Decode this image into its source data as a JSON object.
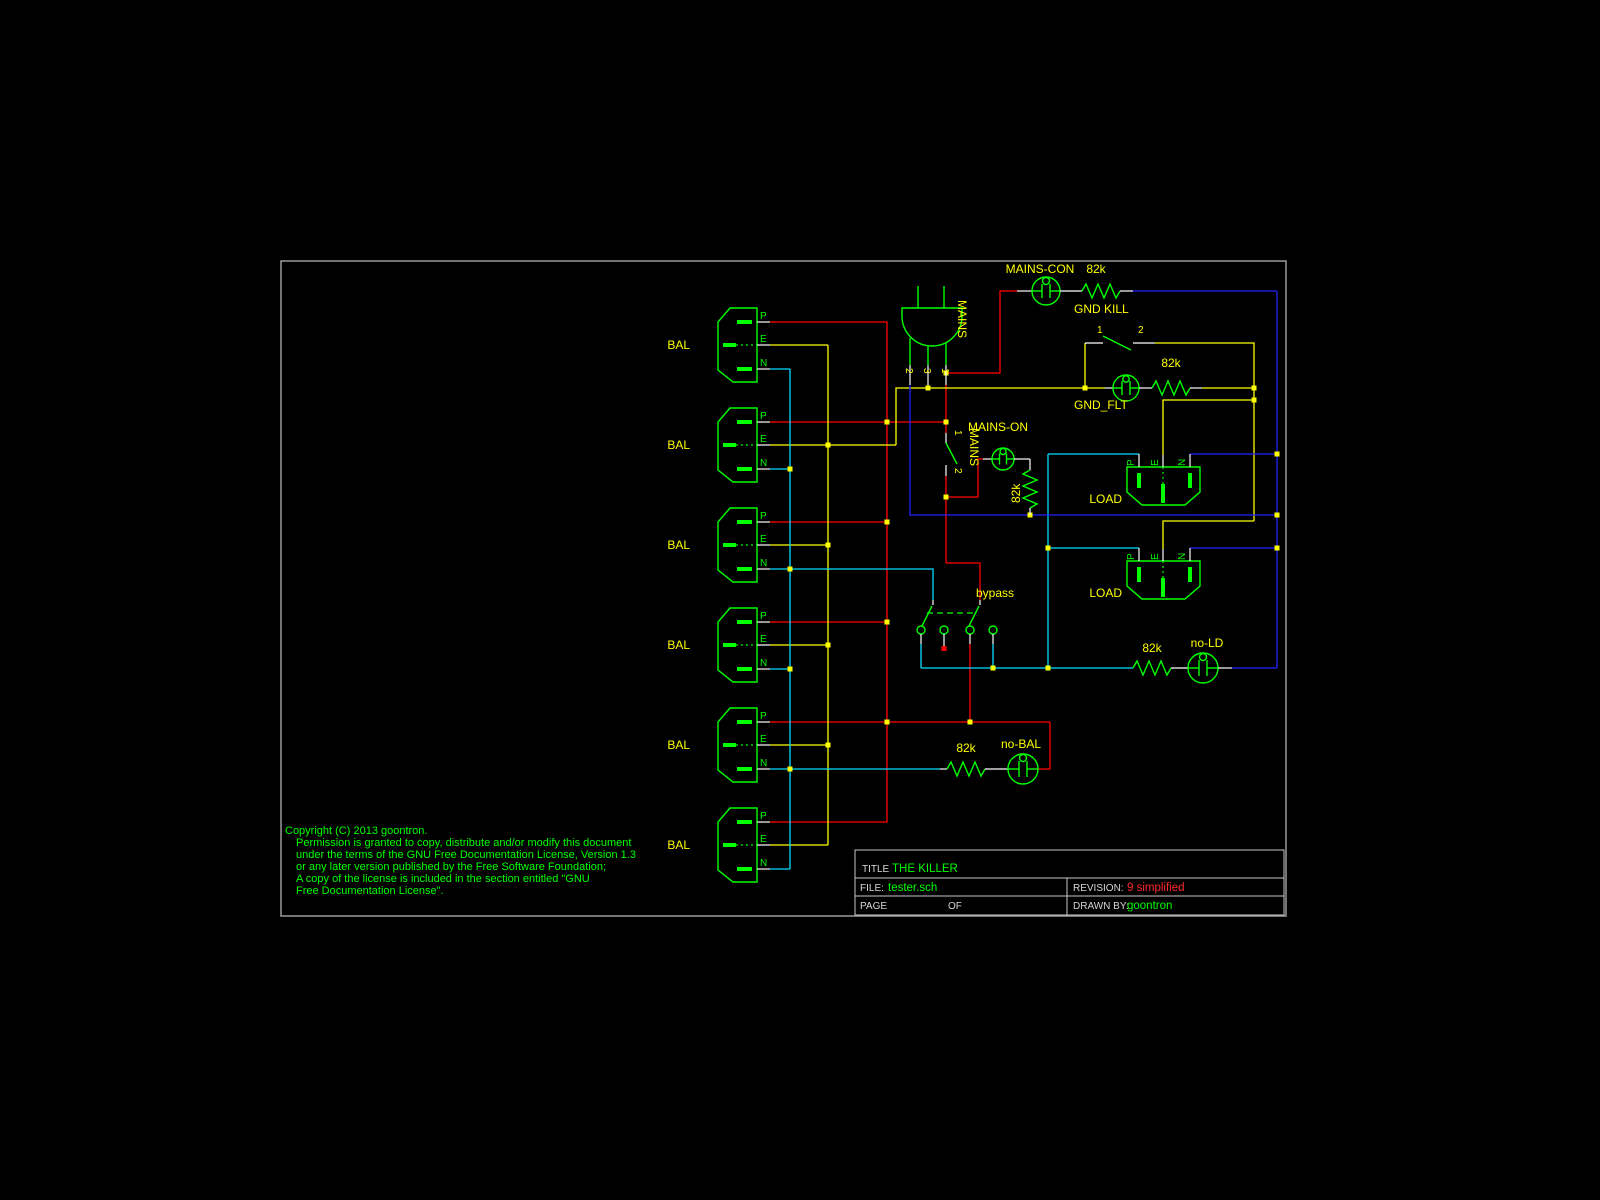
{
  "sheet": {
    "title_label": "TITLE",
    "title": "THE KILLER",
    "file_label": "FILE:",
    "file": "tester.sch",
    "revision_label": "REVISION:",
    "revision": "9 simplified",
    "page_label": "PAGE",
    "of_label": "OF",
    "drawn_label": "DRAWN BY:",
    "drawn_by": "goontron"
  },
  "copyright": {
    "lines": [
      "Copyright (C)  2013 goontron.",
      "Permission is granted to copy, distribute and/or modify this document",
      "under the terms of the GNU Free Documentation License, Version 1.3",
      "or any later version published by the Free Software Foundation;",
      "A copy of the license is included in the section entitled \"GNU",
      "Free Documentation License\"."
    ]
  },
  "labels": {
    "bal": "BAL",
    "load": "LOAD",
    "mains": "MAINS",
    "mains_con": "MAINS-CON",
    "mains_on": "MAINS-ON",
    "gnd_kill": "GND KILL",
    "gnd_flt": "GND_FLT",
    "bypass": "bypass",
    "no_ld": "no-LD",
    "no_bal": "no-BAL",
    "r82k": "82k"
  },
  "pins": {
    "p": "P",
    "e": "E",
    "n": "N",
    "one": "1",
    "two": "2",
    "three": "3"
  },
  "colors": {
    "live": "#ff0000",
    "earth": "#ffff00",
    "neutral_feed": "#00dcff",
    "neutral_return": "#2222ff",
    "component": "#00ff00",
    "label": "#ffff00",
    "lead": "#ffffff",
    "junction": "#ffff00",
    "border": "#9a9a9a",
    "revision": "#ff2a2a",
    "background": "#000000"
  }
}
